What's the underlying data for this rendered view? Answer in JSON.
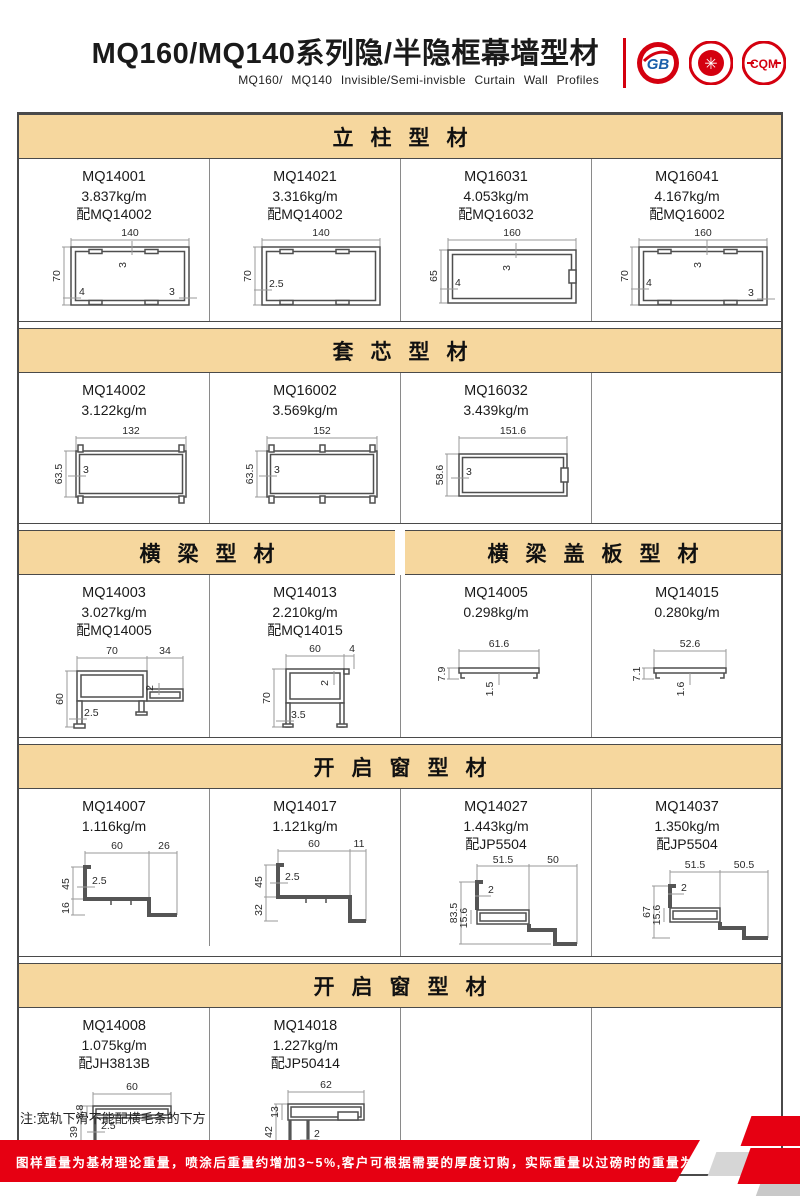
{
  "header": {
    "title": "MQ160/MQ140系列隐/半隐框幕墙型材",
    "subtitle": "MQ160/ MQ140 Invisible/Semi-invisble Curtain Wall Profiles",
    "logos": {
      "logo1": "GB",
      "logo2": "✳",
      "logo3": "CQM"
    }
  },
  "sections": [
    {
      "bands": [
        {
          "label": "立柱型材"
        }
      ],
      "items": [
        {
          "code": "MQ14001",
          "weight": "3.837kg/m",
          "pair": "配MQ14002",
          "dims": {
            "w": "140",
            "h": "70",
            "t_top": "3",
            "t_left": "4",
            "t_right": "3"
          }
        },
        {
          "code": "MQ14021",
          "weight": "3.316kg/m",
          "pair": "配MQ14002",
          "dims": {
            "w": "140",
            "h": "70",
            "t_left": "2.5"
          }
        },
        {
          "code": "MQ16031",
          "weight": "4.053kg/m",
          "pair": "配MQ16032",
          "dims": {
            "w": "160",
            "h": "65",
            "t_top": "3",
            "t_left": "4"
          }
        },
        {
          "code": "MQ16041",
          "weight": "4.167kg/m",
          "pair": "配MQ16002",
          "dims": {
            "w": "160",
            "h": "70",
            "t_top": "3",
            "t_left": "4",
            "t_right": "3"
          }
        }
      ]
    },
    {
      "bands": [
        {
          "label": "套芯型材"
        }
      ],
      "items": [
        {
          "code": "MQ14002",
          "weight": "3.122kg/m",
          "dims": {
            "w": "132",
            "h": "63.5",
            "t": "3"
          }
        },
        {
          "code": "MQ16002",
          "weight": "3.569kg/m",
          "dims": {
            "w": "152",
            "h": "63.5",
            "t": "3"
          }
        },
        {
          "code": "MQ16032",
          "weight": "3.439kg/m",
          "dims": {
            "w": "151.6",
            "h": "58.6",
            "t": "3"
          }
        }
      ]
    },
    {
      "bands": [
        {
          "label": "横梁型材"
        },
        {
          "label": "横梁盖板型材"
        }
      ],
      "items": [
        {
          "code": "MQ14003",
          "weight": "3.027kg/m",
          "pair": "配MQ14005",
          "dims": {
            "w": "70",
            "w2": "34",
            "h": "60",
            "t": "2.5",
            "t2": "2"
          }
        },
        {
          "code": "MQ14013",
          "weight": "2.210kg/m",
          "pair": "配MQ14015",
          "dims": {
            "w": "60",
            "w2": "4",
            "h": "70",
            "t": "3.5",
            "t2": "2"
          }
        },
        {
          "code": "MQ14005",
          "weight": "0.298kg/m",
          "dims": {
            "w": "61.6",
            "h": "7.9",
            "t": "1.5"
          }
        },
        {
          "code": "MQ14015",
          "weight": "0.280kg/m",
          "dims": {
            "w": "52.6",
            "h": "7.1",
            "t": "1.6"
          }
        }
      ]
    },
    {
      "bands": [
        {
          "label": "开启窗型材"
        }
      ],
      "items": [
        {
          "code": "MQ14007",
          "weight": "1.116kg/m",
          "dims": {
            "w": "60",
            "w2": "26",
            "h": "45",
            "h2": "16",
            "t": "2.5"
          }
        },
        {
          "code": "MQ14017",
          "weight": "1.121kg/m",
          "dims": {
            "w": "60",
            "w2": "11",
            "h": "45",
            "h2": "32",
            "t": "2.5"
          }
        },
        {
          "code": "MQ14027",
          "weight": "1.443kg/m",
          "pair": "配JP5504",
          "dims": {
            "w": "51.5",
            "w2": "50",
            "h": "83.5",
            "h2": "15.6",
            "t": "2"
          }
        },
        {
          "code": "MQ14037",
          "weight": "1.350kg/m",
          "pair": "配JP5504",
          "dims": {
            "w": "51.5",
            "w2": "50.5",
            "h": "67",
            "h2": "15.6",
            "t": "2"
          }
        }
      ]
    },
    {
      "bands": [
        {
          "label": "开启窗型材"
        }
      ],
      "items": [
        {
          "code": "MQ14008",
          "weight": "1.075kg/m",
          "pair": "配JH3813B",
          "dims": {
            "w": "60",
            "h": "39",
            "h2": "8.8",
            "t": "2.5"
          }
        },
        {
          "code": "MQ14018",
          "weight": "1.227kg/m",
          "pair": "配JP50414",
          "dims": {
            "w": "62",
            "h": "42",
            "h2": "13",
            "t": "2"
          }
        }
      ]
    }
  ],
  "note": "注:宽轨下滑不能配横毛条的下方",
  "footer": {
    "text": "图样重量为基材理论重量，喷涂后重量约增加3~5%,客户可根据需要的厚度订购，实际重量以过磅时的重量为准。",
    "brand_line1": "JIAHUA",
    "brand_line2": "ALUMINIUM",
    "page": "07"
  },
  "colors": {
    "accent_red": "#e60012",
    "band_tan": "#f6d79e",
    "logo_red": "#d4000f",
    "logo_blue": "#1b5faa"
  }
}
